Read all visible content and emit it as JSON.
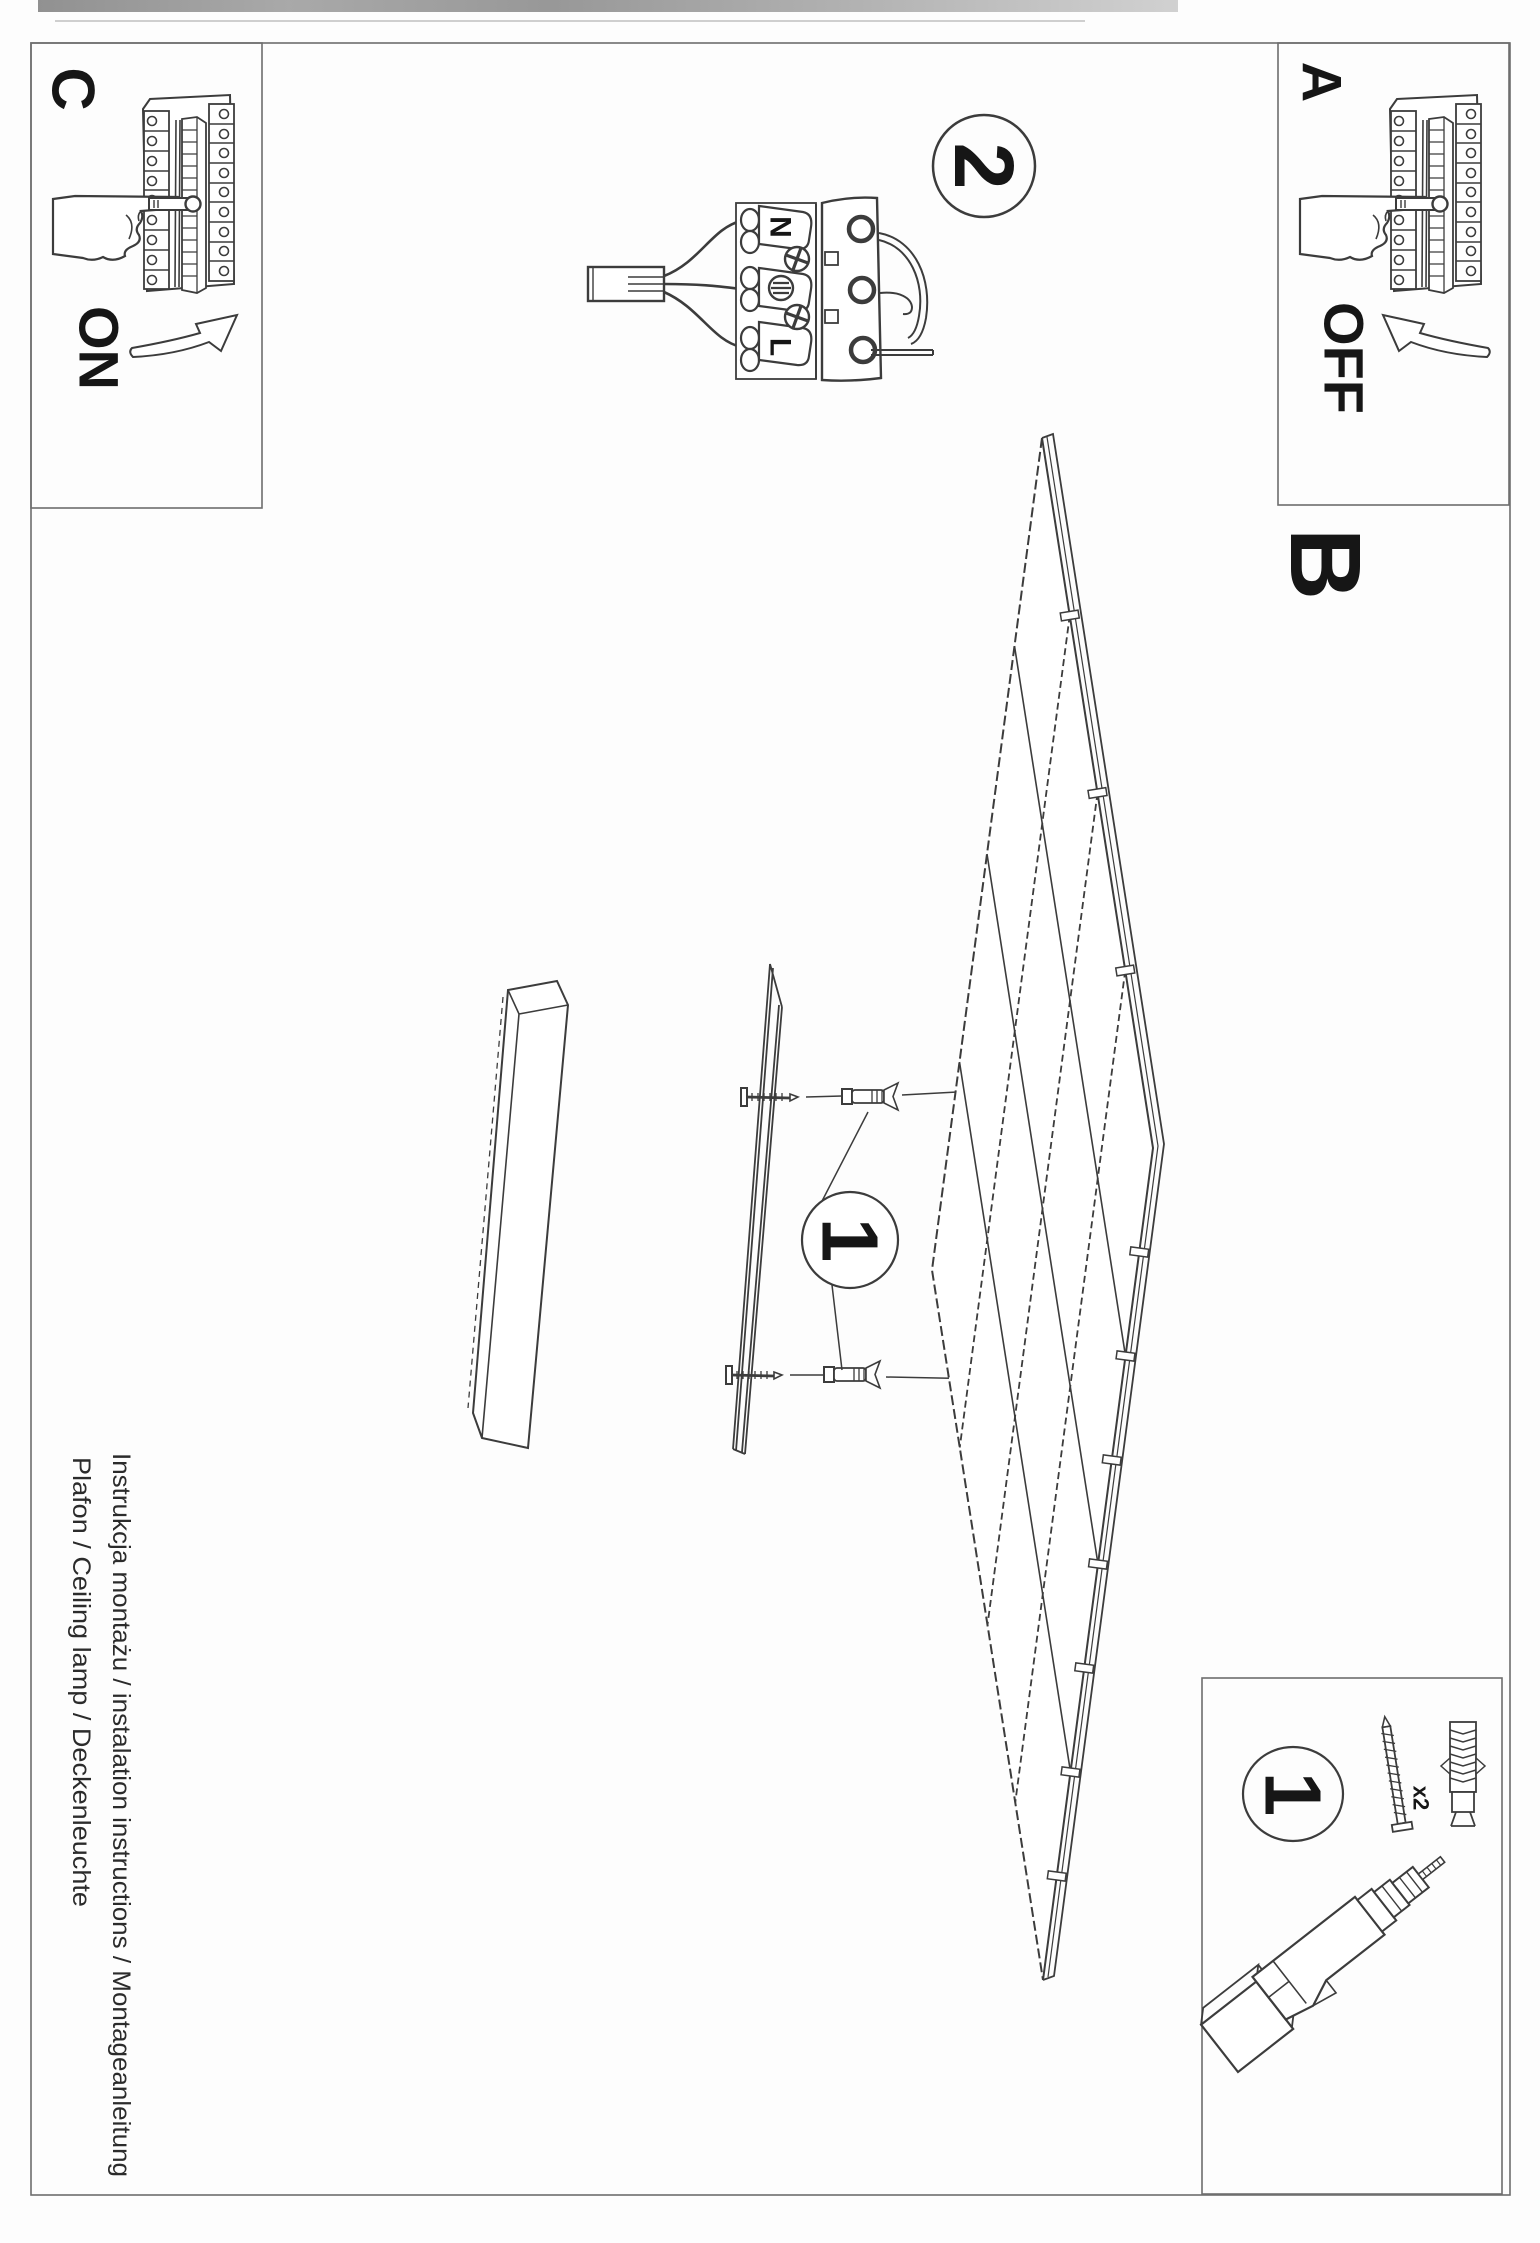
{
  "page": {
    "kind": "scanned installation manual, rotated 90 degrees",
    "footer": {
      "line1": "Instrukcja montażu / instalation instructions / Montageanleitung",
      "line2": "Plafon / Ceiling lamp / Deckenleuchte"
    }
  },
  "steps": {
    "a": {
      "label": "A",
      "switch_state": "OFF"
    },
    "b": {
      "label": "B"
    },
    "c": {
      "label": "C",
      "switch_state": "ON"
    },
    "step1_badge": "1",
    "step2_badge": "2"
  },
  "wiring_labels": {
    "neutral": "N",
    "live": "L"
  },
  "hardware": {
    "badge": "1",
    "screw_quantity": "x2"
  },
  "colors": {
    "ink": "#3c3c3c",
    "text": "#161616",
    "frame": "#6e6e6e"
  }
}
